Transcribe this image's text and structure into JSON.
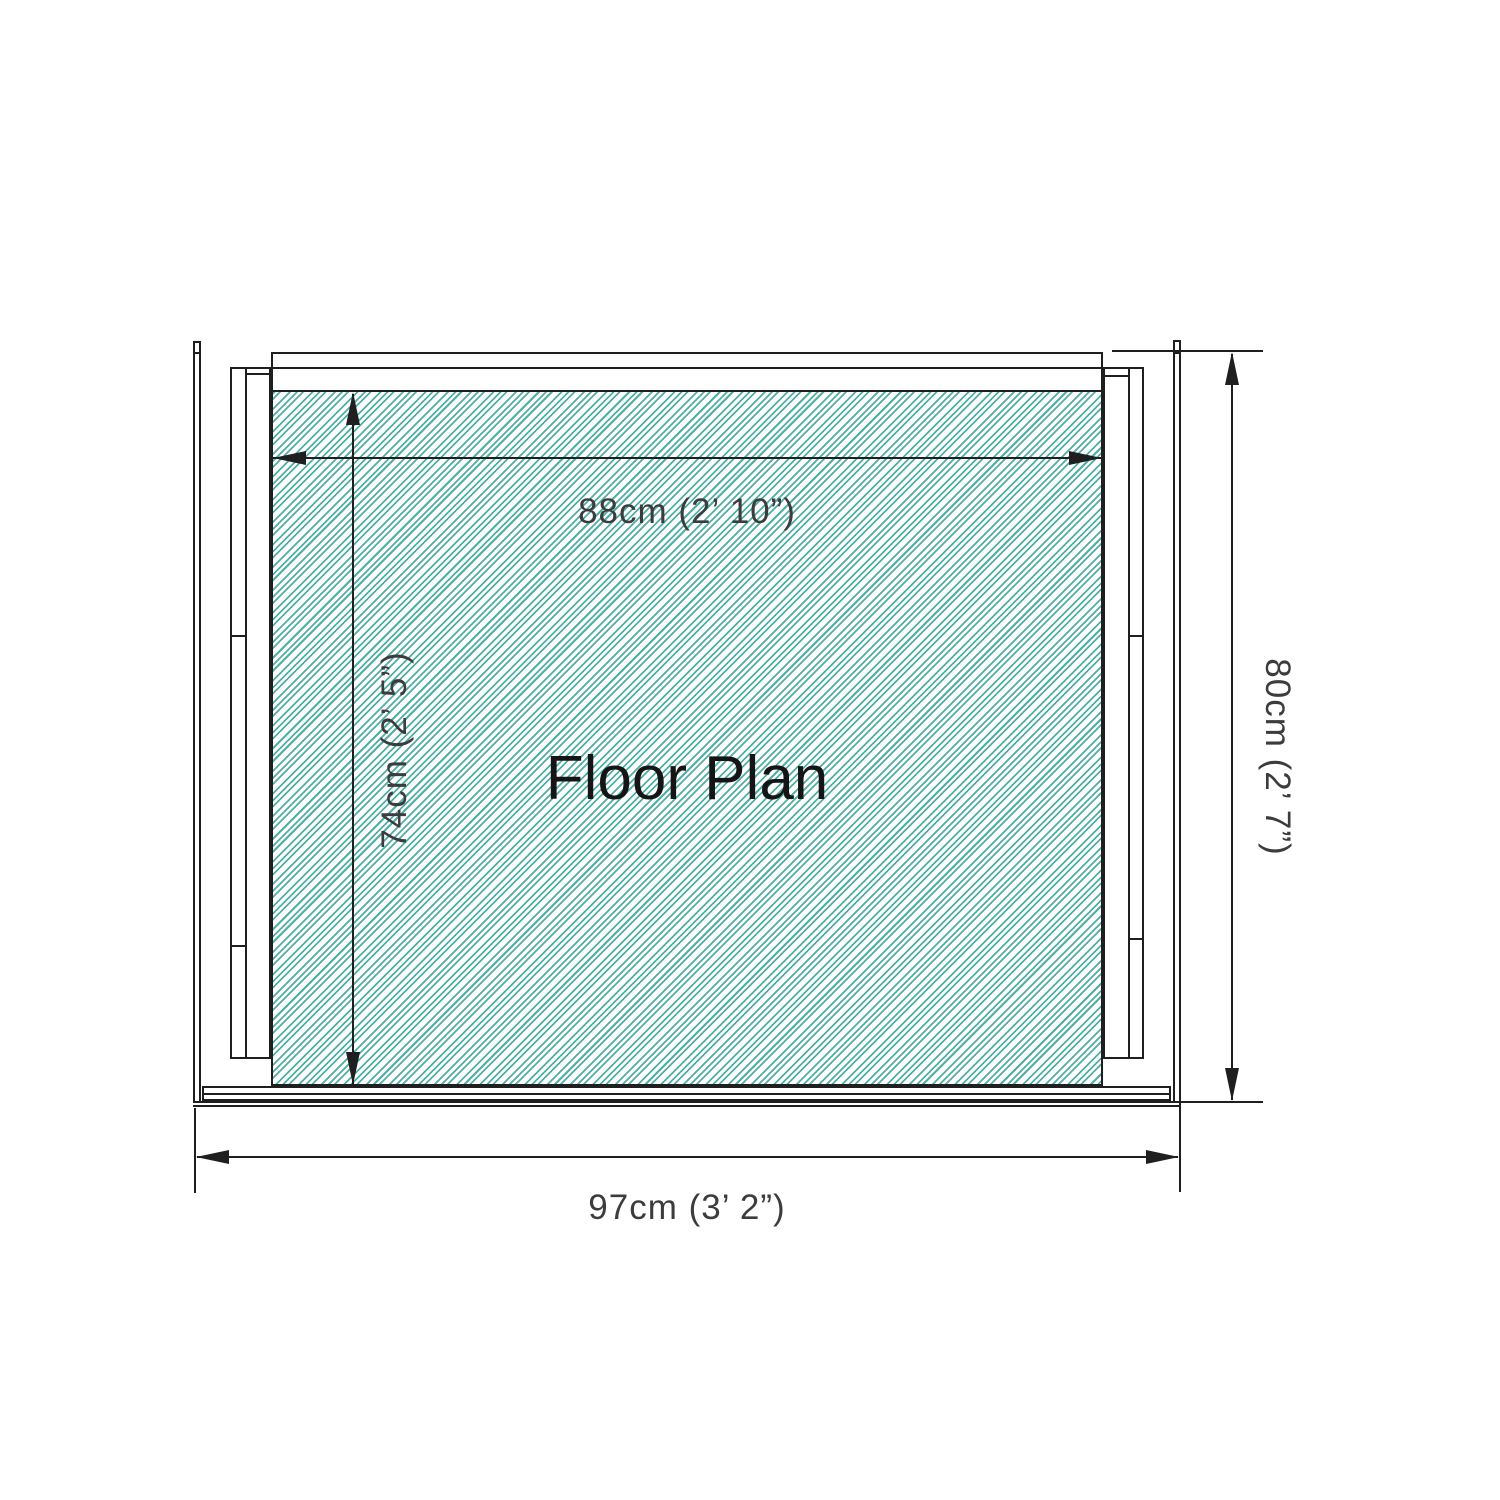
{
  "diagram": {
    "type": "floor-plan",
    "title": "Floor Plan",
    "dimensions": {
      "inner_width": {
        "label": "88cm (2’ 10”)",
        "cm": 88,
        "imperial": "2’ 10”"
      },
      "inner_depth": {
        "label": "74cm (2’ 5”)",
        "cm": 74,
        "imperial": "2’ 5”"
      },
      "outer_depth": {
        "label": "80cm (2’ 7”)",
        "cm": 80,
        "imperial": "2’ 7”"
      },
      "outer_width": {
        "label": "97cm (3’ 2”)",
        "cm": 97,
        "imperial": "3’ 2”"
      }
    },
    "colors": {
      "hatch": "#4fafa6",
      "line": "#1f1f1f",
      "text": "#3c3c3c"
    }
  }
}
